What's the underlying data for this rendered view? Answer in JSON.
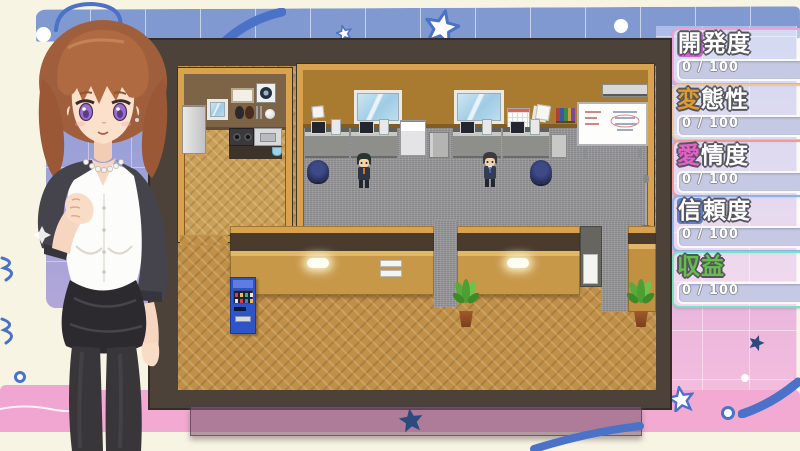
{
  "hud": {
    "stats": [
      {
        "id": "development",
        "label": "開発度",
        "first": "開",
        "rest": "発度",
        "value_display": "0 / 100",
        "current": 0,
        "max": 100,
        "style": "block",
        "accent": "#d45fd4",
        "border": "#f0a2d4"
      },
      {
        "id": "hentai-level",
        "label": "変態性",
        "first": "変",
        "rest": "態性",
        "value_display": "0 / 100",
        "current": 0,
        "max": 100,
        "style": "glyph",
        "accent": "#e09b28",
        "border": "#f0c694"
      },
      {
        "id": "affection",
        "label": "愛情度",
        "first": "愛",
        "rest": "情度",
        "value_display": "0 / 100",
        "current": 0,
        "max": 100,
        "style": "glyph",
        "accent": "#e85fc8",
        "border": "#ef9b98"
      },
      {
        "id": "trust",
        "label": "信頼度",
        "first": "信",
        "rest": "頼度",
        "value_display": "0 / 100",
        "current": 0,
        "max": 100,
        "style": "block",
        "accent": "#5a82d8",
        "border": "#8fb0ea"
      },
      {
        "id": "profit",
        "label": "収益",
        "first": "収",
        "rest": "益",
        "value_display": "0 / 100",
        "current": 0,
        "max": 100,
        "style": "glyph-all",
        "accent": "#66be4a",
        "border": "#72e6c0"
      }
    ]
  },
  "palette": {
    "background_cream": "#f8f4e3",
    "background_blue_band": "#8099d0",
    "background_pink_band": "#f2aad2",
    "doodle_blue": "#4a72c8",
    "map_frame_brown": "#4c423a",
    "map_wall_tan_frame": "#d9a24f",
    "map_wood_floor": "#c09048",
    "map_carpet": "#98989a",
    "stand_star_navy": "#2b4a7e",
    "vending_machine_blue": "#2e55c8"
  }
}
